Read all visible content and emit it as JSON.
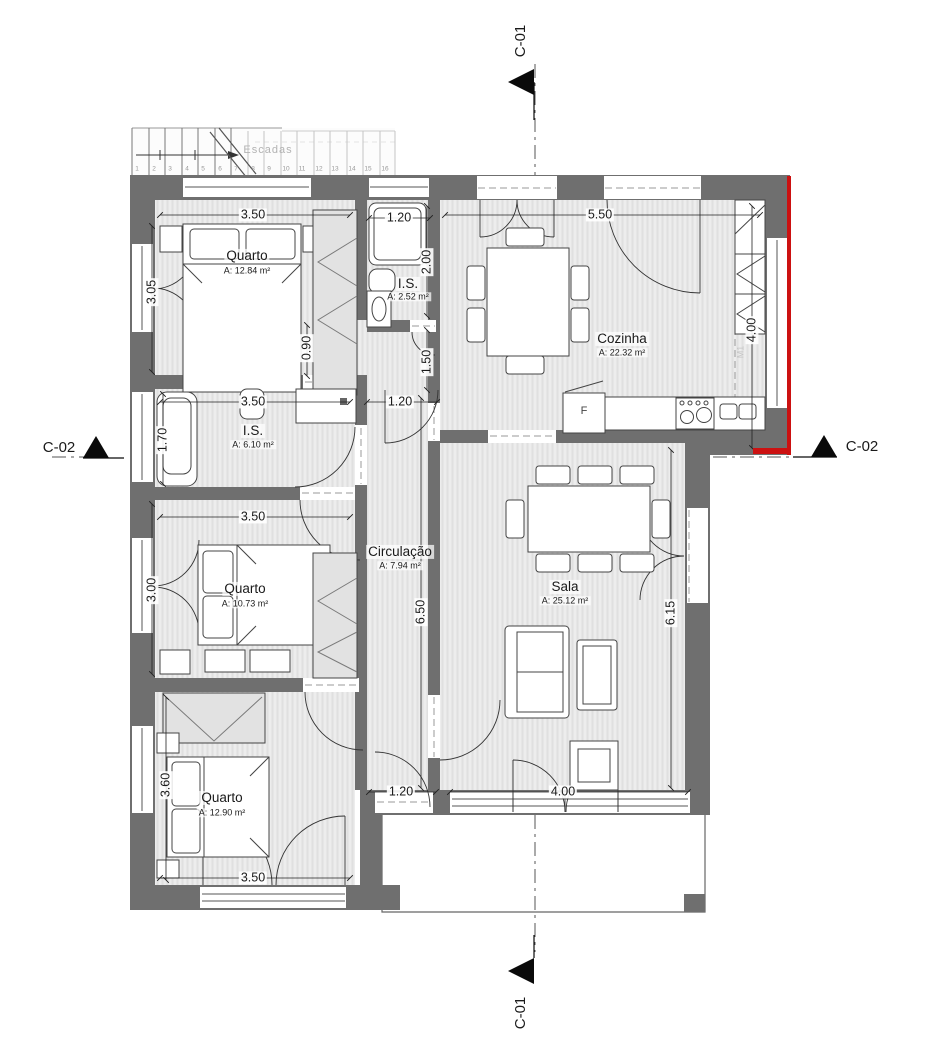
{
  "drawing": {
    "rooms": [
      {
        "id": "quarto1",
        "name": "Quarto",
        "area": "A: 12.84 m²"
      },
      {
        "id": "is-small",
        "name": "I.S.",
        "area": "A: 2.52 m²"
      },
      {
        "id": "cozinha",
        "name": "Cozinha",
        "area": "A: 22.32 m²"
      },
      {
        "id": "is-main",
        "name": "I.S.",
        "area": "A: 6.10 m²"
      },
      {
        "id": "circulacao",
        "name": "Circulação",
        "area": "A: 7.94 m²"
      },
      {
        "id": "quarto2",
        "name": "Quarto",
        "area": "A: 10.73 m²"
      },
      {
        "id": "sala",
        "name": "Sala",
        "area": "A: 25.12 m²"
      },
      {
        "id": "quarto3",
        "name": "Quarto",
        "area": "A: 12.90 m²"
      }
    ],
    "dimensions": {
      "bed1_width": "3.50",
      "is_small_width": "1.20",
      "kitchen_width": "5.50",
      "is_small_height": "2.00",
      "bed1_height": "3.05",
      "kitchen_height": "4.00",
      "hall_passage": "0.90",
      "hall_upper": "1.50",
      "is_main_width": "3.50",
      "kitchen_door": "1.20",
      "bathtub": "1.70",
      "bed2_width": "3.50",
      "bed2_height": "3.00",
      "circulation_length": "6.50",
      "sala_height": "6.15",
      "bed3_height": "3.60",
      "patio_door": "1.20",
      "sala_doors": "4.00",
      "bed3_width": "3.50"
    },
    "section_markers": {
      "c01_top": "C-01",
      "c01_bottom": "C-01",
      "c02_left": "C-02",
      "c02_right": "C-02"
    },
    "stairs": {
      "label": "Escadas",
      "steps": [
        "1",
        "2",
        "3",
        "4",
        "5",
        "6",
        "7",
        "8",
        "9",
        "10",
        "11",
        "12",
        "13",
        "14",
        "15",
        "16"
      ]
    },
    "labels": {
      "fridge": "F",
      "wall_tag": "M1"
    },
    "colors": {
      "wall": "#6f6f6f",
      "accent": "#cc1111",
      "floor": "#ededed"
    }
  }
}
